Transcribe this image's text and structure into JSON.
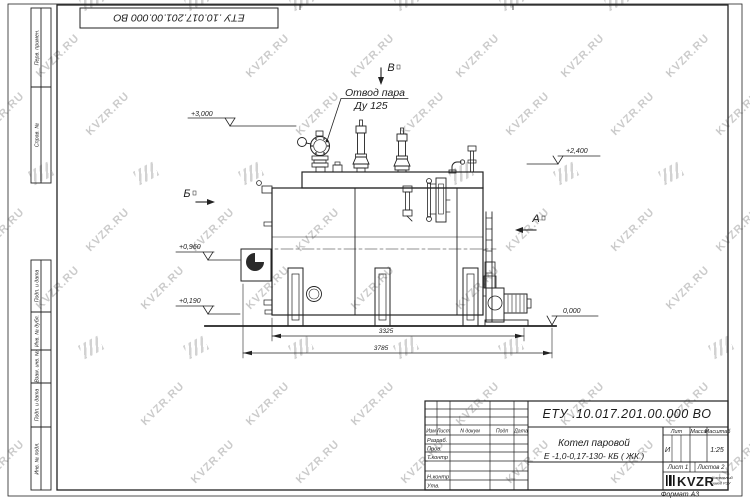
{
  "sheet": {
    "watermark_text": "KVZR.RU",
    "format_note": "Формат А3"
  },
  "top_stamp": {
    "doc_number": "ЕТУ .10.017.201.00.000  ВО"
  },
  "side_columns": {
    "top": [
      "Перв. примен.",
      "Справ. №"
    ],
    "bottom": [
      "Подп. и дата",
      "Инв. № дубл.",
      "Взам. инв. №",
      "Подп. и дата",
      "Инв. № подл."
    ]
  },
  "drawing": {
    "callout": {
      "line1": "Отвод пара",
      "line2": "Ду 125"
    },
    "views": {
      "top": "В",
      "left": "Б",
      "right": "А"
    },
    "elevations": {
      "e1": "+3,000",
      "e2": "+2,400",
      "e3": "+0,960",
      "e4": "+0,190",
      "e5": "0,000"
    },
    "dimensions": {
      "inner": "3325",
      "outer": "3785"
    }
  },
  "title_block": {
    "doc_number": "ЕТУ .10.017.201.00.000  ВО",
    "name_line1": "Котел паровой",
    "name_line2": "Е -1,0-0,17-130- КБ ( ЖК )",
    "rev_header": [
      "Изм",
      "Лист",
      "N докум",
      "Подп",
      "Дата"
    ],
    "sign_rows": [
      "Разраб.",
      "Пров.",
      "Т.контр",
      "Н.контр",
      "Утв."
    ],
    "lit_label": "Лит",
    "mass_label": "Масса",
    "scale_label": "Масштаб",
    "lit_value": "И",
    "scale_value": "1:25",
    "sheet_info": "Лист 1",
    "sheets_info": "Листов 2",
    "logo_text": "KVZR",
    "logo_caption1": "Котельный",
    "logo_caption2": "завод РЭУ"
  }
}
